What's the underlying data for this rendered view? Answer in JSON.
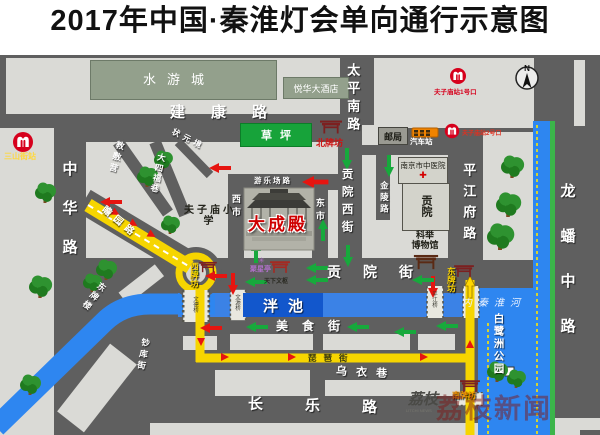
{
  "title": "2017年中国·秦淮灯会单向通行示意图",
  "compass": {
    "n": "N"
  },
  "colors": {
    "road_bg": "#5f5f5f",
    "block": "#dadad6",
    "river": "#2e86f0",
    "route_yellow": "#f6d500",
    "arrow_red": "#e61510",
    "arrow_green": "#17a93c",
    "metro_red": "#d6001c",
    "lawn_green": "#17a33a",
    "gate_yellow": "#ffd700"
  },
  "landmarks": {
    "shuiyoucheng": "水游城",
    "yuehua_hotel": "悦华大酒店",
    "caoping": "草坪",
    "youju": "邮局",
    "qichezhan": "汽车站",
    "zhongyiyuan": "南京市中医院",
    "gongyuan": "贡院",
    "keju_line1": "科举",
    "keju_line2": "博物馆",
    "fuzimiao_school": "夫子庙小学",
    "dachengdian": "大成殿",
    "juxingting": "聚星亭",
    "tianxiawenshu": "天下文枢",
    "panchi": "泮池",
    "neiqinhuaihe": "内秦淮河",
    "bailuzhou_park": "白鹭洲公园"
  },
  "roads": {
    "jiankang": "建康路",
    "taipingnan": "太平南路",
    "zhonghua": "中华路",
    "longpan": "龙蟠中路",
    "pingjiangfu": "平江府路",
    "gongyuanxi": "贡院西街",
    "jinling": "金陵路",
    "gongyuanjie": "贡院街",
    "meishijie": "美食街",
    "wuyixiang": "乌衣巷",
    "changle": "长乐路",
    "zhanyuan": "瞻园路",
    "jiaofuying": "教敷营",
    "dasifuxiang": "大四福巷",
    "zhuangyuanjing": "状元境",
    "dongpailou": "东牌楼",
    "chaokujie": "钞库街",
    "youlechang": "游乐场路",
    "pipajie": "琵琶街",
    "xishi": "西市",
    "dongshi": "东市"
  },
  "gates": {
    "north": "北牌坊",
    "west": "西牌坊",
    "east": "东牌坊",
    "south": "南牌坊"
  },
  "metro": {
    "sanshanjie": "三山街站",
    "fuzimiao_exit1": "夫子庙站1号口",
    "fuzimiao_exit2": "夫子庙站2号口"
  },
  "bridges": {
    "wende": "文德桥",
    "wenyuan": "文源桥",
    "pingjiang": "平江桥"
  },
  "icons": {
    "red_cross": "✚",
    "star": "✳"
  },
  "watermark": {
    "logo": "荔枝",
    "caption": "LITCHI NEWS",
    "text": "荔枝新闻"
  }
}
